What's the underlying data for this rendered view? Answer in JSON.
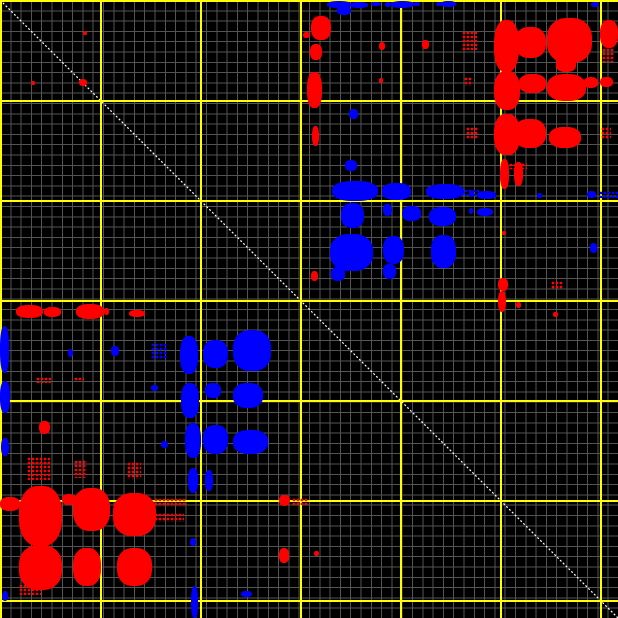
{
  "canvas": {
    "width_px": 618,
    "height_px": 618,
    "background_color": "#000000"
  },
  "colors": {
    "minor_grid": "#545454",
    "major_grid": "#ffff00",
    "diagonal": "#ffffff",
    "forward_match": "#ff0000",
    "reverse_match": "#0000ff"
  },
  "chart_data": {
    "type": "scatter",
    "title": "",
    "xlabel": "",
    "ylabel": "",
    "x_range": [
      0,
      618
    ],
    "y_range": [
      0,
      618
    ],
    "grid": {
      "minor_spacing_px": 10.3,
      "major_spacing_px": 100,
      "major_positions": [
        0,
        100,
        200,
        300,
        400,
        500,
        600
      ]
    },
    "diagonal": {
      "from": [
        0,
        0
      ],
      "to": [
        618,
        618
      ],
      "style": "dotted",
      "color": "#ffffff"
    },
    "series": [
      {
        "name": "red-matches",
        "color": "#ff0000",
        "clusters": [
          [
            494,
            20,
            25,
            52
          ],
          [
            515,
            27,
            31,
            31
          ],
          [
            547,
            18,
            45,
            45
          ],
          [
            556,
            58,
            20,
            14
          ],
          [
            600,
            20,
            18,
            28
          ],
          [
            602,
            48,
            12,
            14,
            1
          ],
          [
            462,
            31,
            15,
            19,
            1
          ],
          [
            494,
            71,
            26,
            39
          ],
          [
            519,
            74,
            27,
            19
          ],
          [
            547,
            74,
            39,
            27
          ],
          [
            584,
            77,
            14,
            11
          ],
          [
            600,
            77,
            13,
            10
          ],
          [
            464,
            77,
            8,
            9,
            1
          ],
          [
            494,
            114,
            26,
            41
          ],
          [
            514,
            119,
            32,
            29
          ],
          [
            549,
            127,
            32,
            21
          ],
          [
            601,
            127,
            10,
            12,
            1
          ],
          [
            466,
            127,
            13,
            12,
            1
          ],
          [
            500,
            159,
            9,
            30
          ],
          [
            514,
            162,
            9,
            24
          ],
          [
            509,
            163,
            18,
            6,
            1
          ],
          [
            311,
            16,
            20,
            24
          ],
          [
            303,
            32,
            7,
            6
          ],
          [
            310,
            44,
            12,
            16
          ],
          [
            307,
            72,
            15,
            36
          ],
          [
            312,
            126,
            7,
            20
          ],
          [
            379,
            42,
            6,
            8
          ],
          [
            379,
            78,
            4,
            5
          ],
          [
            422,
            40,
            7,
            9
          ],
          [
            83,
            31,
            4,
            4
          ],
          [
            31,
            81,
            4,
            4
          ],
          [
            79,
            79,
            8,
            7
          ],
          [
            16,
            305,
            27,
            13
          ],
          [
            44,
            307,
            17,
            10
          ],
          [
            76,
            304,
            28,
            15
          ],
          [
            104,
            308,
            5,
            7
          ],
          [
            129,
            310,
            16,
            7
          ],
          [
            498,
            278,
            10,
            13
          ],
          [
            551,
            281,
            12,
            8,
            1
          ],
          [
            498,
            291,
            8,
            21
          ],
          [
            516,
            302,
            5,
            6
          ],
          [
            553,
            312,
            5,
            5
          ],
          [
            36,
            377,
            15,
            6,
            1
          ],
          [
            74,
            377,
            10,
            5,
            1
          ],
          [
            39,
            421,
            11,
            13
          ],
          [
            311,
            271,
            7,
            10
          ],
          [
            502,
            231,
            4,
            4
          ],
          [
            27,
            457,
            23,
            23,
            1
          ],
          [
            74,
            460,
            13,
            18,
            1
          ],
          [
            127,
            462,
            14,
            17,
            1
          ],
          [
            19,
            486,
            43,
            60
          ],
          [
            0,
            497,
            20,
            14
          ],
          [
            62,
            494,
            14,
            11
          ],
          [
            73,
            488,
            37,
            43
          ],
          [
            113,
            493,
            43,
            43
          ],
          [
            154,
            498,
            32,
            9,
            1
          ],
          [
            154,
            513,
            30,
            9,
            1
          ],
          [
            19,
            545,
            43,
            45
          ],
          [
            73,
            548,
            28,
            38
          ],
          [
            117,
            548,
            35,
            38
          ],
          [
            19,
            584,
            22,
            11,
            1
          ],
          [
            279,
            495,
            11,
            11
          ],
          [
            292,
            498,
            17,
            7,
            1
          ],
          [
            279,
            548,
            10,
            15
          ],
          [
            314,
            551,
            5,
            5
          ]
        ]
      },
      {
        "name": "blue-matches",
        "color": "#0000ff",
        "clusters": [
          [
            327,
            1,
            24,
            7
          ],
          [
            337,
            6,
            14,
            9
          ],
          [
            350,
            2,
            18,
            6
          ],
          [
            371,
            2,
            10,
            4
          ],
          [
            385,
            2,
            6,
            5
          ],
          [
            391,
            1,
            23,
            7
          ],
          [
            414,
            2,
            6,
            4
          ],
          [
            436,
            2,
            6,
            4
          ],
          [
            441,
            1,
            15,
            6
          ],
          [
            591,
            2,
            8,
            5
          ],
          [
            349,
            109,
            9,
            10
          ],
          [
            345,
            160,
            12,
            11
          ],
          [
            332,
            181,
            46,
            20
          ],
          [
            382,
            183,
            29,
            17
          ],
          [
            426,
            184,
            38,
            15
          ],
          [
            464,
            189,
            16,
            7,
            1
          ],
          [
            341,
            203,
            23,
            25
          ],
          [
            383,
            204,
            9,
            12
          ],
          [
            402,
            206,
            19,
            15
          ],
          [
            429,
            207,
            27,
            19
          ],
          [
            330,
            234,
            43,
            37
          ],
          [
            383,
            236,
            21,
            28
          ],
          [
            431,
            235,
            25,
            33
          ],
          [
            383,
            264,
            13,
            15
          ],
          [
            331,
            267,
            14,
            14
          ],
          [
            469,
            191,
            5,
            6
          ],
          [
            477,
            191,
            19,
            8
          ],
          [
            537,
            193,
            5,
            5
          ],
          [
            587,
            191,
            9,
            7
          ],
          [
            599,
            191,
            19,
            7,
            1
          ],
          [
            469,
            208,
            4,
            6
          ],
          [
            477,
            208,
            16,
            8
          ],
          [
            590,
            243,
            7,
            10
          ],
          [
            0,
            326,
            9,
            47
          ],
          [
            0,
            381,
            10,
            32
          ],
          [
            1,
            438,
            8,
            18
          ],
          [
            2,
            591,
            6,
            10
          ],
          [
            68,
            349,
            5,
            8
          ],
          [
            111,
            346,
            8,
            10
          ],
          [
            151,
            343,
            17,
            17,
            1
          ],
          [
            151,
            385,
            7,
            6
          ],
          [
            161,
            441,
            7,
            7
          ],
          [
            180,
            336,
            18,
            38
          ],
          [
            203,
            340,
            25,
            28
          ],
          [
            233,
            330,
            38,
            41
          ],
          [
            181,
            383,
            18,
            35
          ],
          [
            205,
            383,
            16,
            15
          ],
          [
            233,
            383,
            30,
            25
          ],
          [
            185,
            423,
            16,
            35
          ],
          [
            203,
            425,
            25,
            29
          ],
          [
            233,
            430,
            35,
            24
          ],
          [
            188,
            468,
            10,
            25
          ],
          [
            205,
            470,
            8,
            21
          ],
          [
            190,
            538,
            6,
            8
          ],
          [
            191,
            586,
            7,
            32
          ],
          [
            241,
            591,
            11,
            6
          ]
        ]
      }
    ]
  }
}
